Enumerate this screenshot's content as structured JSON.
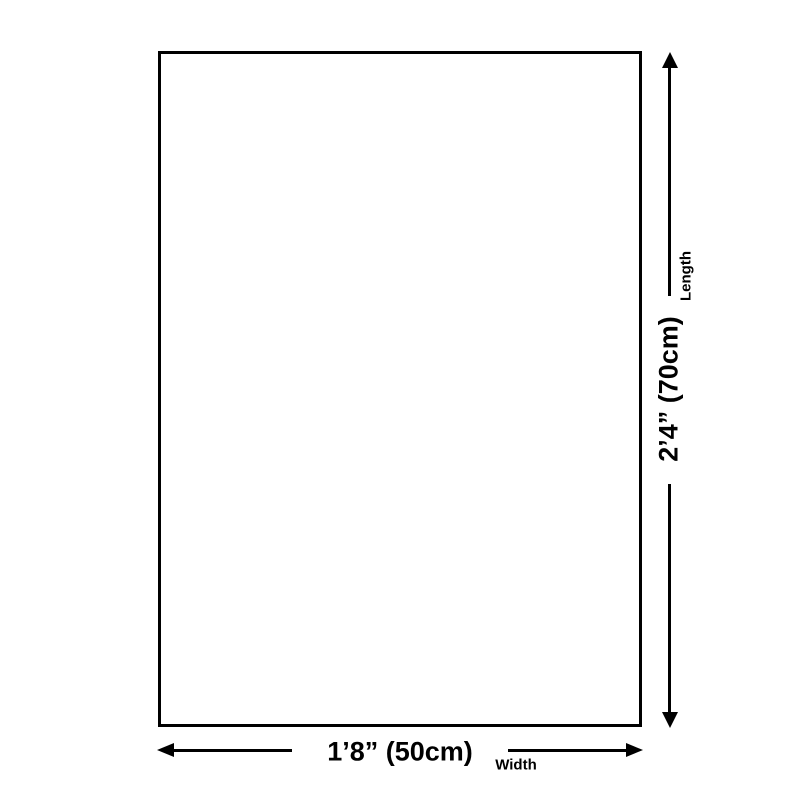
{
  "page": {
    "background_color": "#ffffff"
  },
  "diagram": {
    "line_color": "#000000",
    "length": {
      "value": "2’4” (70cm)",
      "label": "Length"
    },
    "width": {
      "value": "1’8” (50cm)",
      "label": "Width"
    }
  }
}
